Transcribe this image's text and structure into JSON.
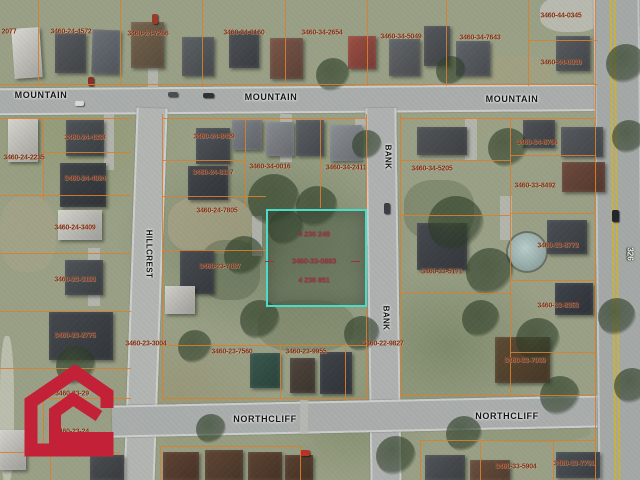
{
  "map": {
    "selected_parcel": {
      "x": 266,
      "y": 209,
      "w": 97,
      "h": 94,
      "border_color": "#49dcc8",
      "labels": [
        {
          "text": "4 236 248",
          "x": 314,
          "y": 234
        },
        {
          "text": "3460-33-0883",
          "x": 314,
          "y": 261
        },
        {
          "text": "4 236 851",
          "x": 314,
          "y": 280
        }
      ]
    },
    "parcel_labels": [
      {
        "text": "2077",
        "x": 9,
        "y": 32
      },
      {
        "text": "3460-24-4572",
        "x": 71,
        "y": 32
      },
      {
        "text": "3460-24-7266",
        "x": 148,
        "y": 34
      },
      {
        "text": "3460-34-0160",
        "x": 244,
        "y": 33
      },
      {
        "text": "3460-34-2654",
        "x": 322,
        "y": 33
      },
      {
        "text": "3460-34-5049",
        "x": 401,
        "y": 37
      },
      {
        "text": "3460-34-7643",
        "x": 480,
        "y": 38
      },
      {
        "text": "3460-44-0345",
        "x": 561,
        "y": 16
      },
      {
        "text": "3460-44-0030",
        "x": 561,
        "y": 63
      },
      {
        "text": "3460-24-4338",
        "x": 85,
        "y": 138
      },
      {
        "text": "3460-24-2235",
        "x": 24,
        "y": 158
      },
      {
        "text": "3460-24-4024",
        "x": 85,
        "y": 179
      },
      {
        "text": "3460-24-8429",
        "x": 214,
        "y": 137
      },
      {
        "text": "3460-24-8117",
        "x": 213,
        "y": 173
      },
      {
        "text": "3460-34-0016",
        "x": 270,
        "y": 167
      },
      {
        "text": "3460-34-2411",
        "x": 346,
        "y": 168
      },
      {
        "text": "3460-34-5205",
        "x": 432,
        "y": 169
      },
      {
        "text": "3460-34-8706",
        "x": 537,
        "y": 143
      },
      {
        "text": "3460-33-8492",
        "x": 535,
        "y": 186
      },
      {
        "text": "3460-24-7805",
        "x": 217,
        "y": 211
      },
      {
        "text": "3460-24-3409",
        "x": 75,
        "y": 228
      },
      {
        "text": "3460-23-7887",
        "x": 220,
        "y": 267
      },
      {
        "text": "3460-33-8772",
        "x": 558,
        "y": 246
      },
      {
        "text": "3460-33-5171",
        "x": 442,
        "y": 272
      },
      {
        "text": "3460-23-3193",
        "x": 75,
        "y": 280
      },
      {
        "text": "3460-23-2775",
        "x": 75,
        "y": 336
      },
      {
        "text": "3460-23-3004",
        "x": 146,
        "y": 344
      },
      {
        "text": "3460-22-9827",
        "x": 383,
        "y": 344
      },
      {
        "text": "3460-23-7560",
        "x": 232,
        "y": 352
      },
      {
        "text": "3460-23-9955",
        "x": 306,
        "y": 352
      },
      {
        "text": "3460-33-8353",
        "x": 558,
        "y": 306
      },
      {
        "text": "3460-33-7039",
        "x": 525,
        "y": 361
      },
      {
        "text": "3460-23-29",
        "x": 72,
        "y": 394
      },
      {
        "text": "3460-23-24",
        "x": 72,
        "y": 432
      },
      {
        "text": "3460-33-5904",
        "x": 516,
        "y": 467
      },
      {
        "text": "3460-33-7701",
        "x": 574,
        "y": 464
      }
    ],
    "street_labels": [
      {
        "text": "MOUNTAIN",
        "x": 41,
        "y": 95,
        "rotate": 0
      },
      {
        "text": "MOUNTAIN",
        "x": 271,
        "y": 97,
        "rotate": 0
      },
      {
        "text": "MOUNTAIN",
        "x": 512,
        "y": 99,
        "rotate": 0
      },
      {
        "text": "HILLCREST",
        "x": 149,
        "y": 254,
        "rotate": 90
      },
      {
        "text": "BANK",
        "x": 388,
        "y": 157,
        "rotate": 90
      },
      {
        "text": "BANK",
        "x": 386,
        "y": 318,
        "rotate": 90
      },
      {
        "text": "NORTHCLIFF",
        "x": 265,
        "y": 419,
        "rotate": 0
      },
      {
        "text": "NORTHCLIFF",
        "x": 507,
        "y": 416,
        "rotate": 0
      }
    ],
    "route_label": {
      "text": "326",
      "x": 630,
      "y": 254
    },
    "colors": {
      "parcel_label": "#7c2a16",
      "highlight_label": "#a1303c",
      "highlight_border": "#49dcc8",
      "lot_line": "#d8802e",
      "logo_red": "#c32138"
    }
  },
  "icons": {
    "logo": "red-house-outline-logo"
  }
}
